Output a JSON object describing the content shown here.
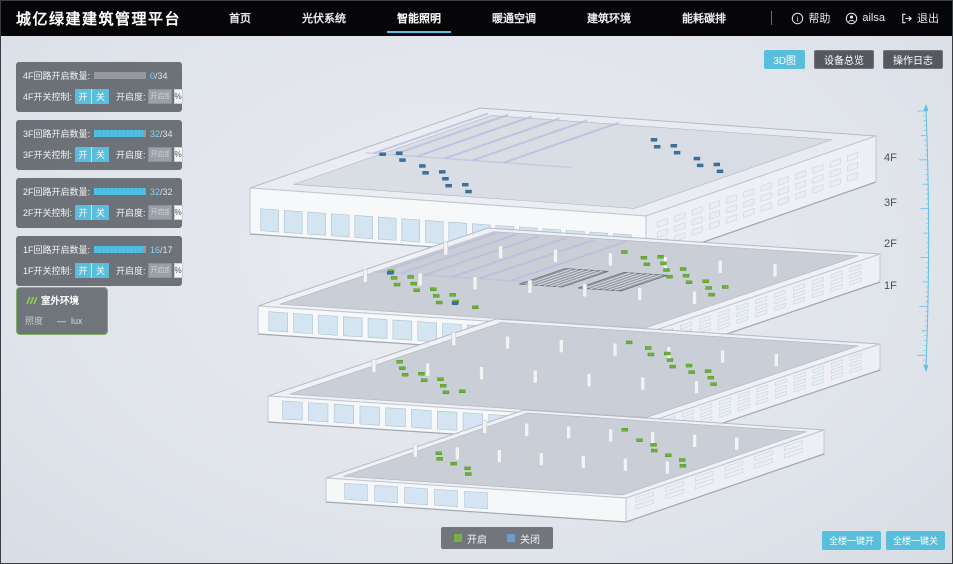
{
  "header": {
    "title": "城亿绿建建筑管理平台",
    "nav": [
      {
        "label": "首页"
      },
      {
        "label": "光伏系统"
      },
      {
        "label": "智能照明"
      },
      {
        "label": "暖通空调"
      },
      {
        "label": "建筑环境"
      },
      {
        "label": "能耗碳排"
      }
    ],
    "help": "帮助",
    "user": "ailsa",
    "logout": "退出"
  },
  "toolbar": {
    "view_3d": "3D图",
    "device_overview": "设备总览",
    "operation_log": "操作日志"
  },
  "floor_panels": [
    {
      "count_label": "4F回路开启数量:",
      "open": "0",
      "total": "/34",
      "percent": 0,
      "switch_label": "4F开关控制:",
      "on_label": "开",
      "off_label": "关",
      "dim_label": "开启度:",
      "dim_placeholder": "开启度",
      "unit": "%"
    },
    {
      "count_label": "3F回路开启数量:",
      "open": "32",
      "total": "/34",
      "percent": 94,
      "switch_label": "3F开关控制:",
      "on_label": "开",
      "off_label": "关",
      "dim_label": "开启度:",
      "dim_placeholder": "开启度",
      "unit": "%"
    },
    {
      "count_label": "2F回路开启数量:",
      "open": "32",
      "total": "/32",
      "percent": 100,
      "switch_label": "2F开关控制:",
      "on_label": "开",
      "off_label": "关",
      "dim_label": "开启度:",
      "dim_placeholder": "开启度",
      "unit": "%"
    },
    {
      "count_label": "1F回路开启数量:",
      "open": "16",
      "total": "/17",
      "percent": 94,
      "switch_label": "1F开关控制:",
      "on_label": "开",
      "off_label": "关",
      "dim_label": "开启度:",
      "dim_placeholder": "开启度",
      "unit": "%"
    }
  ],
  "outdoor": {
    "title": "室外环境",
    "metric_label": "照度",
    "value": "—",
    "unit": "lux"
  },
  "floor_axis": {
    "labels": [
      "4F",
      "3F",
      "2F",
      "1F"
    ]
  },
  "legend": {
    "on": {
      "label": "开启",
      "color": "#76b043"
    },
    "off": {
      "label": "关闭",
      "color": "#6e9bd1"
    }
  },
  "bottom_actions": {
    "all_on": "全楼一键开",
    "all_off": "全楼一键关"
  },
  "colors": {
    "accent": "#58bedc",
    "nav_underline": "#4fc3e8",
    "light_on": "#69b32e",
    "light_off": "#39729f"
  }
}
